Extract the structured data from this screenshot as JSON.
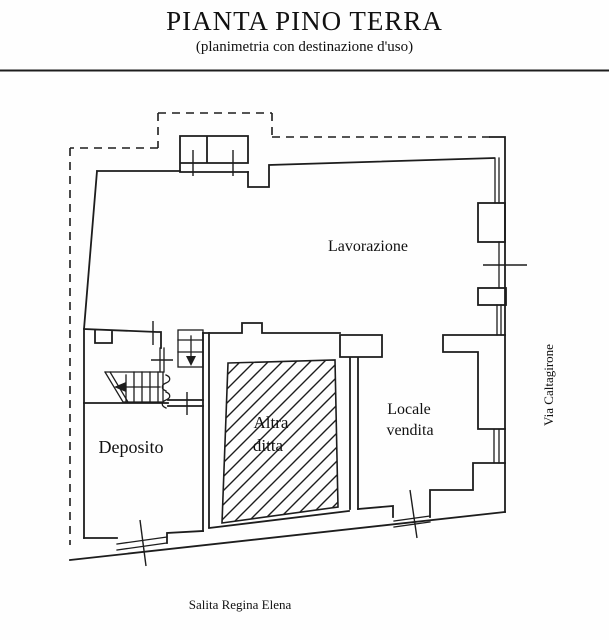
{
  "header": {
    "title": "PIANTA PINO TERRA",
    "subtitle": "(planimetria con destinazione d'uso)"
  },
  "plan": {
    "rooms": {
      "lavorazione": {
        "label": "Lavorazione"
      },
      "deposito": {
        "label": "Deposito"
      },
      "altra_ditta": {
        "line1": "Altra",
        "line2": "ditta"
      },
      "locale_vendita": {
        "line1": "Locale",
        "line2": "vendita"
      }
    },
    "streets": {
      "right": "Via Caltagirone",
      "bottom": "Salita Regina Elena"
    }
  },
  "colors": {
    "line": "#1d1d1d",
    "background": "#ffffff",
    "text": "#111111"
  }
}
